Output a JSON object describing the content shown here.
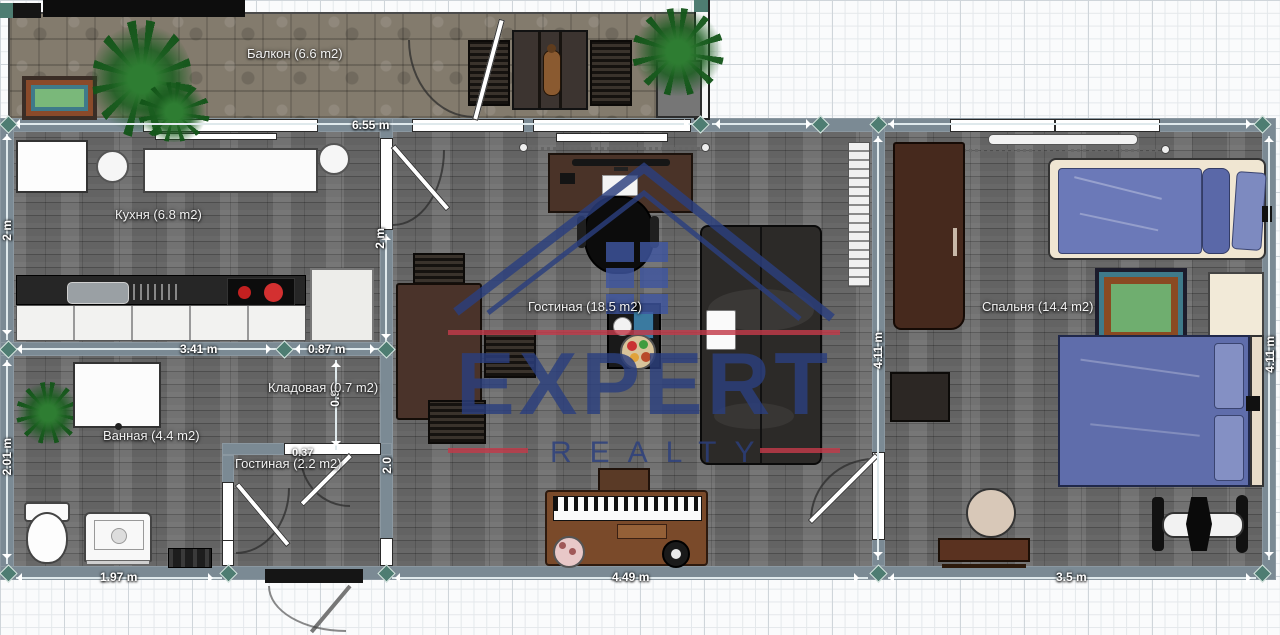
{
  "watermark": {
    "brand_top": "EXPERT",
    "brand_bottom": "REALTY",
    "color_blue": "#2b3f7e",
    "color_red": "#c23b4a"
  },
  "rooms": {
    "balcony": {
      "label": "Балкон (6.6 m2)"
    },
    "kitchen": {
      "label": "Кухня (6.8 m2)"
    },
    "living": {
      "label": "Гостиная (18.5 m2)"
    },
    "bedroom": {
      "label": "Спальня (14.4 m2)"
    },
    "bathroom": {
      "label": "Ванная (4.4 m2)"
    },
    "storage": {
      "label": "Кладовая (0.7 m2)"
    },
    "hallway": {
      "label": "Гостиная (2.2 m2)"
    }
  },
  "dimensions": {
    "balcony_top": "6.55 m",
    "kitchen_left": "2 m",
    "kitchen_right": "2 m",
    "kitchen_bottom": "3.41 m",
    "storage_top": "0.87 m",
    "storage_height": "0.9",
    "hallway_small": "0.37",
    "hallway_right": "2.0",
    "bathroom_left": "2.01 m",
    "bathroom_bottom": "1.97 m",
    "living_bottom": "4.49 m",
    "bedroom_left": "4.11 m",
    "bedroom_right": "4.11 m",
    "bedroom_bottom": "3.5 m"
  },
  "palette": {
    "wall": "#7b8a94",
    "node_teal": "#4e7d72",
    "wood_floor": "#6a6a6a",
    "stone_floor": "#837b6d",
    "bed_blue": "#5f6dab",
    "rug_green": "#6fae6f",
    "accent_red": "#c23b4a",
    "watermark_blue": "#2b3f7e"
  }
}
